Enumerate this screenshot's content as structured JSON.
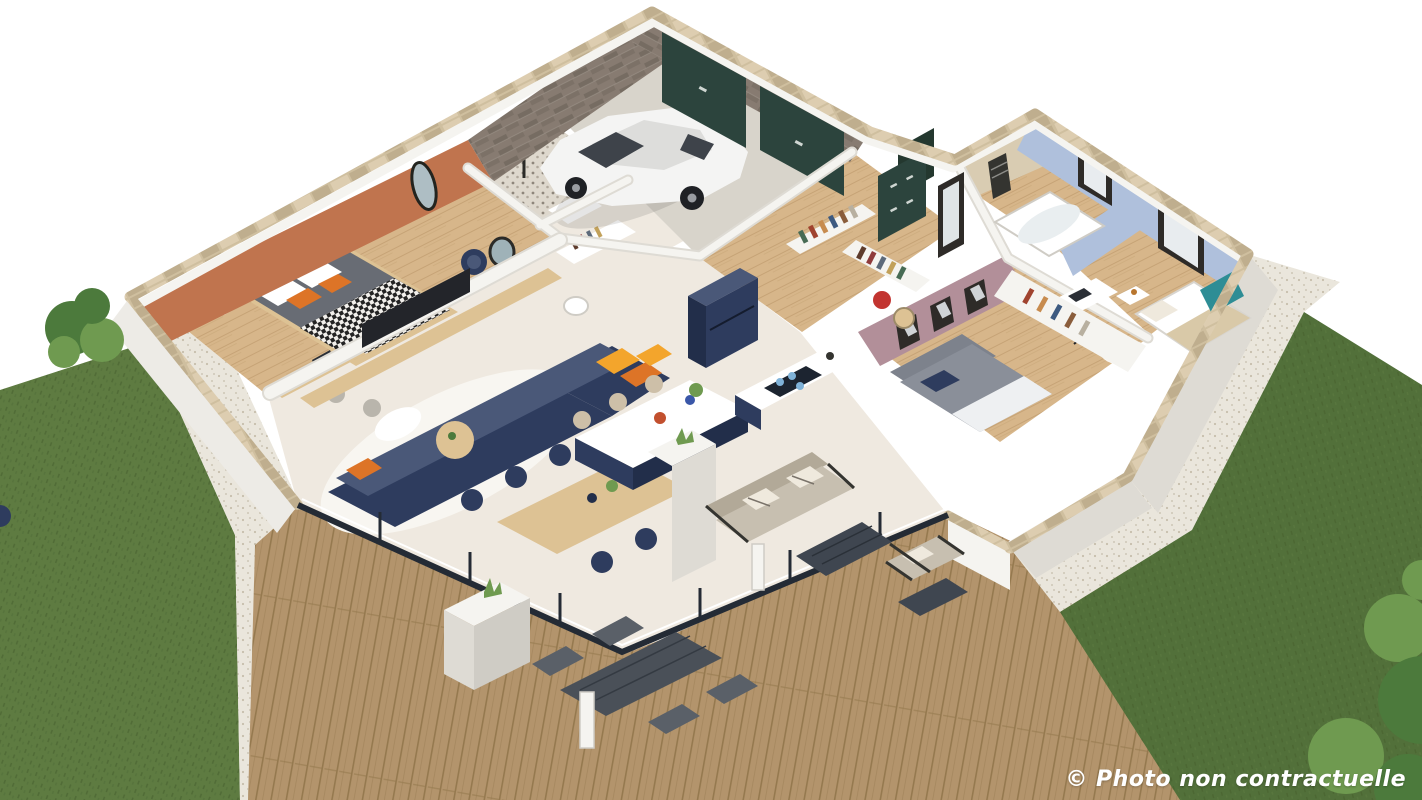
{
  "watermark": {
    "text": "© Photo non contractuelle"
  },
  "palette": {
    "lawn": "#5e7b41",
    "lawn_dark": "#52703a",
    "lawn_speck": "#47612f",
    "gravel": "#eae6dc",
    "gravel_dot": "#c6beac",
    "deck": "#b3946c",
    "deck_line": "#95794f",
    "floor": "#efe9e0",
    "wood": "#d7b68a",
    "wood_line": "#c29f70",
    "concrete": "#d8d4cb",
    "wall": "#f5f4f0",
    "wall_shade": "#dedbd4",
    "wall_dark": "#cfccc5",
    "cap": "#cfbf9f",
    "brick": "#877b71",
    "brick_dark": "#6f655c",
    "orange_wall": "#c0744e",
    "blue_wall": "#afc0dc",
    "mauve_wall": "#b28f99",
    "bath_stone": "#d9ccb2",
    "green_door": "#2c443d",
    "navy": "#2e3c5e",
    "navy_dark": "#222e4a",
    "navy_light": "#4a5878",
    "yellow": "#f3a52c",
    "orange": "#dd7427",
    "red": "#c23430",
    "teal": "#2e8d95",
    "sofa_out": "#c7bfb0",
    "sofa_out_dark": "#b2a998",
    "frame_dark": "#343430",
    "glass": "#242b35",
    "car": "#f4f4f3",
    "car_shadow": "#dddddb",
    "car_glass": "#3e434a",
    "white": "#ffffff",
    "rug": "#f8f6f1",
    "table_wood": "#ddc294",
    "stool": "#cdbfa8",
    "plant": "#4c7a3c",
    "plant_light": "#6f9a50"
  },
  "book_spines": [
    "#a0432f",
    "#c78b4e",
    "#3d5a80",
    "#8a5d3b",
    "#b8b0a0",
    "#5e3c2c",
    "#8f3b3b",
    "#5d6a7a",
    "#c2a15a",
    "#476b54"
  ],
  "scene": {
    "type": "isometric-3d-floor-plan-render",
    "rooms": [
      {
        "name": "master-bedroom",
        "accent_wall": "terracotta"
      },
      {
        "name": "shower-room"
      },
      {
        "name": "storage-wc"
      },
      {
        "name": "garage",
        "vehicle": "white-hatchback",
        "doors": "dark-green"
      },
      {
        "name": "entry-hall",
        "cabinet": "dark-green"
      },
      {
        "name": "kitchen",
        "cabinets": "navy"
      },
      {
        "name": "living-dining-room",
        "sofa": "navy",
        "accent_pillows": "yellow-orange"
      },
      {
        "name": "hallway",
        "feature": "bookshelf-half-walls"
      },
      {
        "name": "bathroom",
        "fixture": "bathtub"
      },
      {
        "name": "bedroom-2",
        "accent_wall": "light-blue"
      },
      {
        "name": "bedroom-3",
        "accent_wall": "mauve-pink"
      },
      {
        "name": "terrace",
        "deck": "wood"
      }
    ],
    "exterior": {
      "left_lawn": true,
      "right_lawn": true,
      "gravel_paths": true,
      "wood_decks": true,
      "shrubs": true,
      "outdoor_furniture": [
        "outdoor-sofa",
        "lounge-chair",
        "coffee-tables",
        "dining-set",
        "planters",
        "light-bollards"
      ]
    }
  }
}
